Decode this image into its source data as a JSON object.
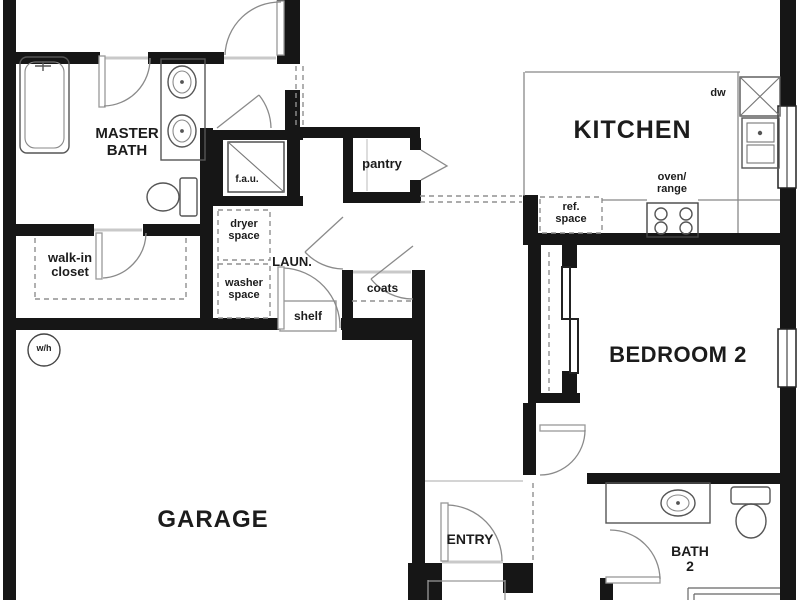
{
  "labels": {
    "master_bath": [
      "MASTER",
      "BATH"
    ],
    "walk_in_closet": [
      "walk-in",
      "closet"
    ],
    "laundry": "LAUN.",
    "dryer_space": [
      "dryer",
      "space"
    ],
    "washer_space": [
      "washer",
      "space"
    ],
    "pantry": "pantry",
    "coats": "coats",
    "shelf": "shelf",
    "fau": "f.a.u.",
    "water_heater": "w/h",
    "kitchen": "KITCHEN",
    "dishwasher": "dw",
    "oven_range": [
      "oven/",
      "range"
    ],
    "ref_space": [
      "ref.",
      "space"
    ],
    "bedroom_2": "BEDROOM 2",
    "garage": "GARAGE",
    "entry": "ENTRY",
    "bath_2": [
      "BATH",
      "2"
    ]
  },
  "colors": {
    "wall": "#161616",
    "fixture_line": "#555555",
    "light_line": "#999999",
    "text": "#1c1c1c",
    "background": "#ffffff"
  }
}
